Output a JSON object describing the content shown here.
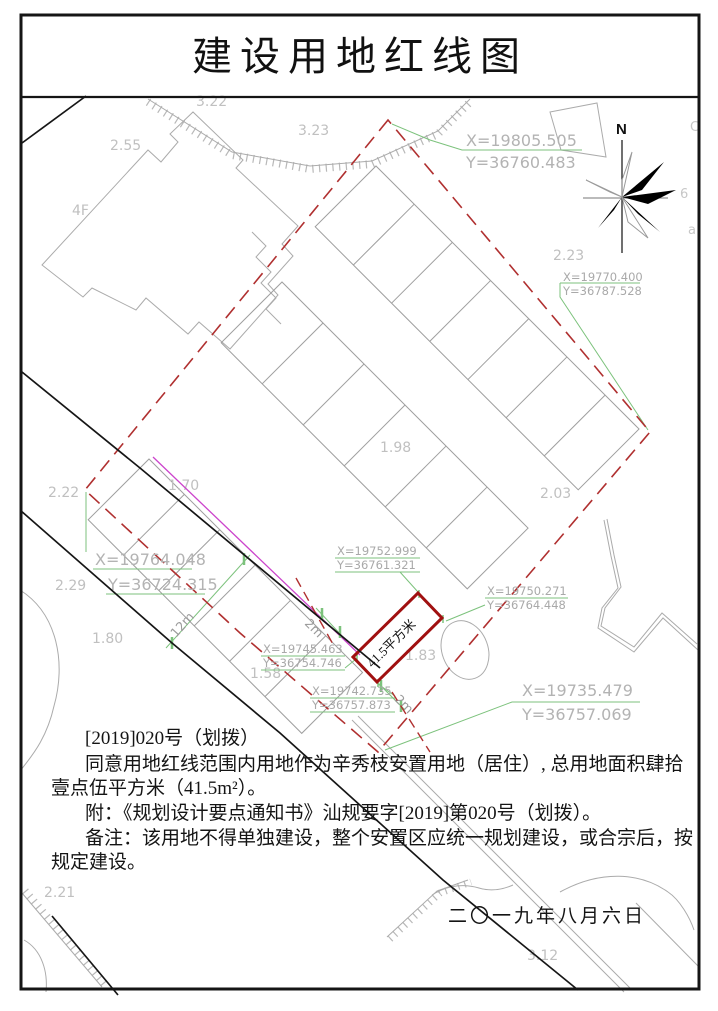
{
  "title": "建设用地红线图",
  "compass": {
    "label": "N"
  },
  "coordinates": {
    "p1": {
      "x": "X=19805.505",
      "y": "Y=36760.483"
    },
    "p2": {
      "x": "X=19770.400",
      "y": "Y=36787.528"
    },
    "p3": {
      "x": "X=19764.048",
      "y": "Y=36724.315"
    },
    "p4": {
      "x": "X=19752.999",
      "y": "Y=36761.321"
    },
    "p5": {
      "x": "X=19750.271",
      "y": "Y=36764.448"
    },
    "p6": {
      "x": "X=19745.463",
      "y": "Y=36754.746"
    },
    "p7": {
      "x": "X=19742.735",
      "y": "Y=36757.873"
    },
    "p8": {
      "x": "X=19735.479",
      "y": "Y=36757.069"
    }
  },
  "labels": {
    "area": "41.5平方米",
    "dim_road": "12m",
    "dim_offset_a": "2m",
    "dim_offset_b": "2m",
    "floors": "4F",
    "elev_322": "3.22",
    "elev_255": "2.55",
    "elev_323": "3.23",
    "elev_223": "2.23",
    "elev_198": "1.98",
    "elev_203": "2.03",
    "elev_222": "2.22",
    "elev_170": "1.70",
    "elev_229": "2.29",
    "elev_180": "1.80",
    "elev_158": "1.58",
    "elev_183": "1.83",
    "elev_221": "2.21",
    "elev_312": "3.12",
    "edge_c": "C",
    "edge_6": "6",
    "edge_a": "a"
  },
  "notes": {
    "line1": "[2019]020号（划拨）",
    "line2": "同意用地红线范围内用地作为辛秀枝安置用地（居住）, 总用地面积肆拾",
    "line3": "壹点伍平方米（41.5m²）。",
    "line4": "附：《规划设计要点通知书》汕规要字[2019]第020号（划拨）。",
    "line5": "备注：该用地不得单独建设，整个安置区应统一规划建设，或合宗后，按",
    "line6": "规定建设。"
  },
  "date": "二〇一九年八月六日",
  "colors": {
    "red_line": "#b03030",
    "parcel_red": "#a01010",
    "green": "#7cc27c",
    "magenta": "#cc44cc",
    "gray": "#ababab"
  }
}
